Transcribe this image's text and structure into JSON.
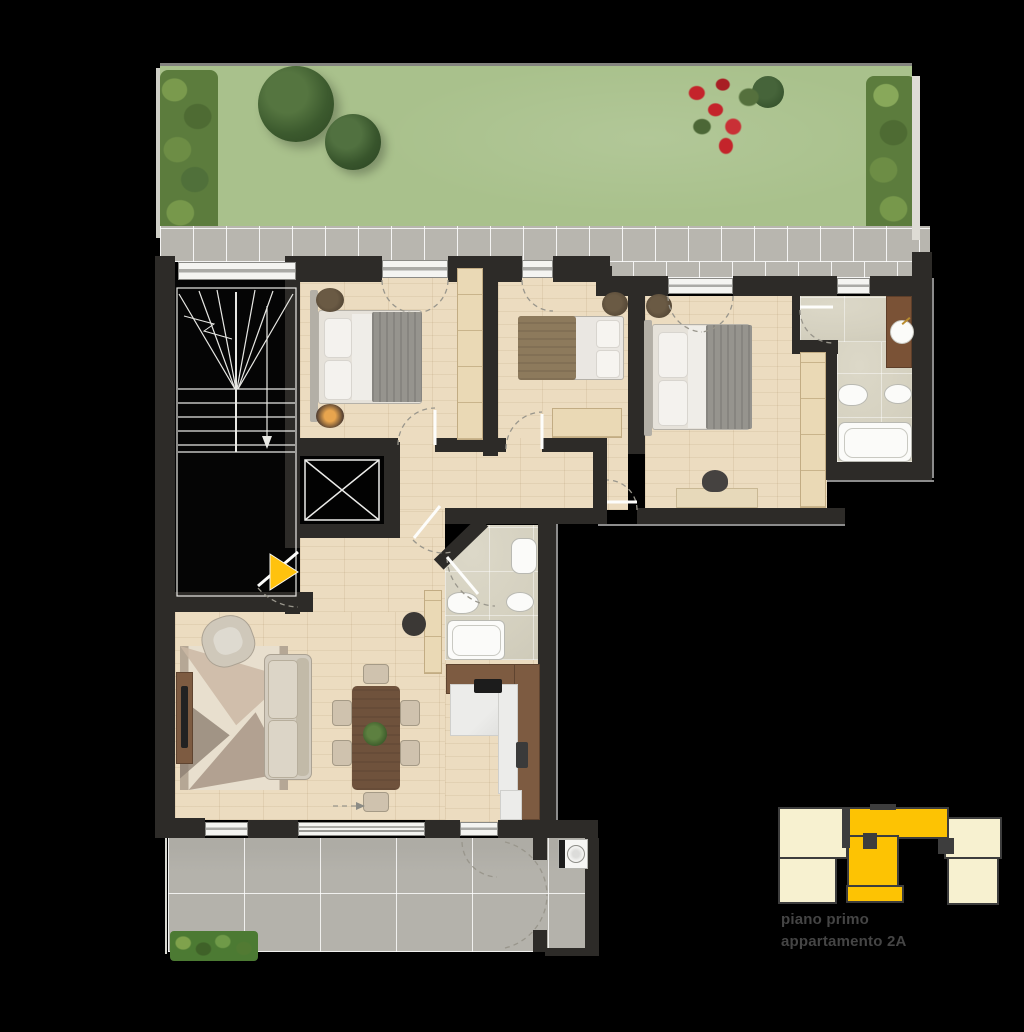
{
  "caption": {
    "floor": "piano primo",
    "apartment": "appartamento 2A"
  },
  "colors": {
    "accent": "#ffc20e",
    "wall": "#2d2b28",
    "wood": "#ecdcc0",
    "stone": "#d6d2c1",
    "lawn": "#a9c18c",
    "hedge": "#5c7c3d",
    "flower": "#c4242b",
    "path": "#b8b6af",
    "terrace": "#b4b2ab",
    "keyplan_pale": "#f7f1d0",
    "keyplan_yellow": "#fdc303",
    "caption_text": "#454545",
    "fixture": "#fbfbf9"
  }
}
